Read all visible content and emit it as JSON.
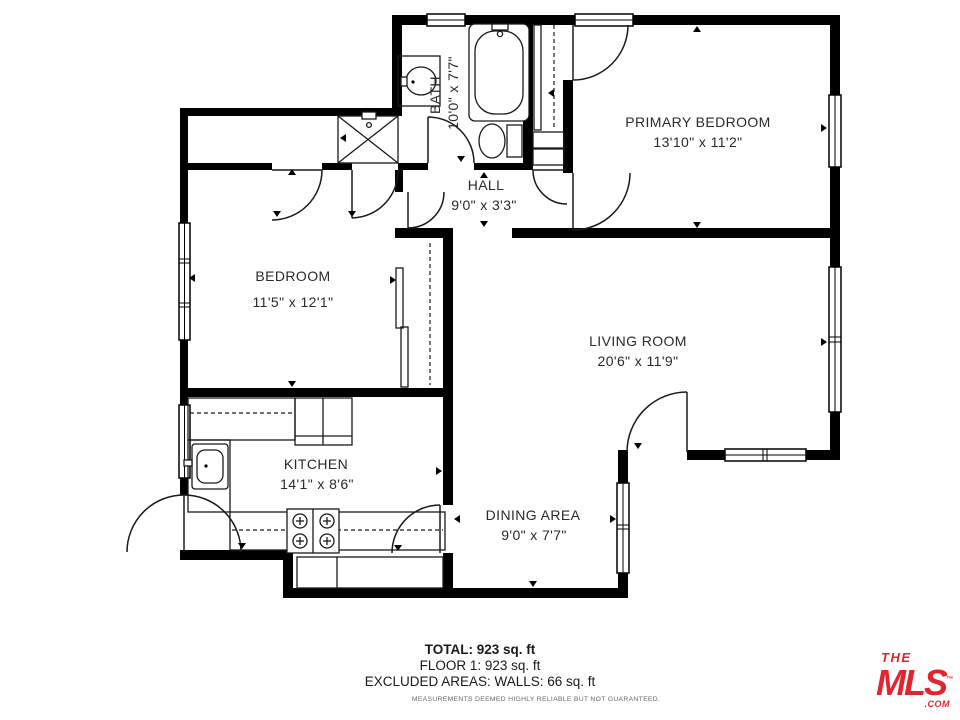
{
  "plan": {
    "rooms": [
      {
        "name": "BATH",
        "dims": "10'0\" x 7'7\""
      },
      {
        "name": "HALL",
        "dims": "9'0\" x 3'3\""
      },
      {
        "name": "PRIMARY BEDROOM",
        "dims": "13'10\" x 11'2\""
      },
      {
        "name": "BEDROOM",
        "dims": "11'5\" x 12'1\""
      },
      {
        "name": "LIVING ROOM",
        "dims": "20'6\" x 11'9\""
      },
      {
        "name": "KITCHEN",
        "dims": "14'1\" x 8'6\""
      },
      {
        "name": "DINING AREA",
        "dims": "9'0\" x 7'7\""
      }
    ]
  },
  "summary": {
    "total": "TOTAL: 923 sq. ft",
    "floor": "FLOOR 1: 923 sq. ft",
    "excluded": "EXCLUDED AREAS: WALLS: 66 sq. ft",
    "disclaimer": "MEASUREMENTS DEEMED HIGHLY RELIABLE BUT NOT GUARANTEED."
  },
  "logo": {
    "the": "THE",
    "mls": "MLS",
    "tm": "™",
    "com": ".COM"
  },
  "colors": {
    "walls": "#000000",
    "lines": "#1a1a1a",
    "logo_red": "#e2242f",
    "disclaimer_gray": "#6a6a6a"
  }
}
